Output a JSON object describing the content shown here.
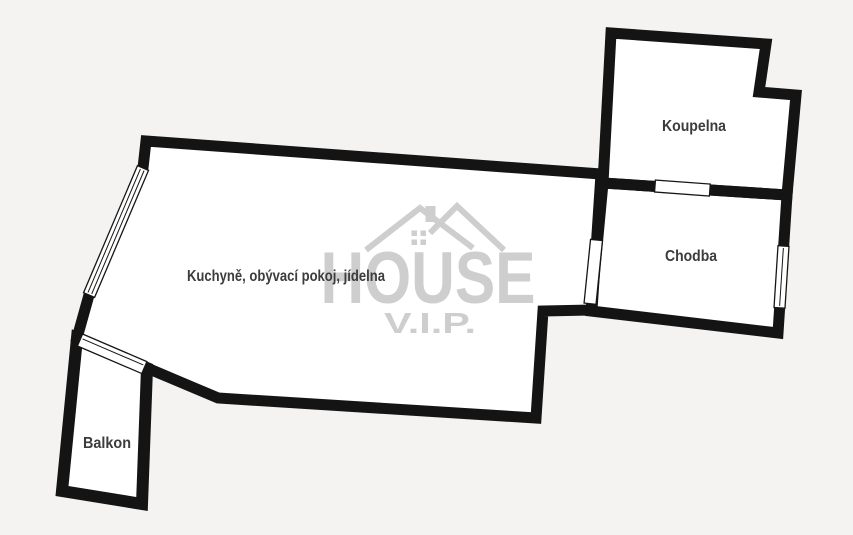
{
  "plan": {
    "type": "apartment-floor-plan",
    "colors": {
      "background": "#f5f3f1",
      "wall": "#141414",
      "room_fill": "#ffffff",
      "label": "#3c3c3c",
      "watermark": "#cecece"
    },
    "rooms": [
      {
        "id": "living",
        "label": "Kuchyně, obývací pokoj, jídelna"
      },
      {
        "id": "bathroom",
        "label": "Koupelna"
      },
      {
        "id": "hallway",
        "label": "Chodba"
      },
      {
        "id": "balcony",
        "label": "Balkon"
      }
    ],
    "watermark": {
      "brand": "HOUSE",
      "suffix": "V.I.P."
    }
  }
}
